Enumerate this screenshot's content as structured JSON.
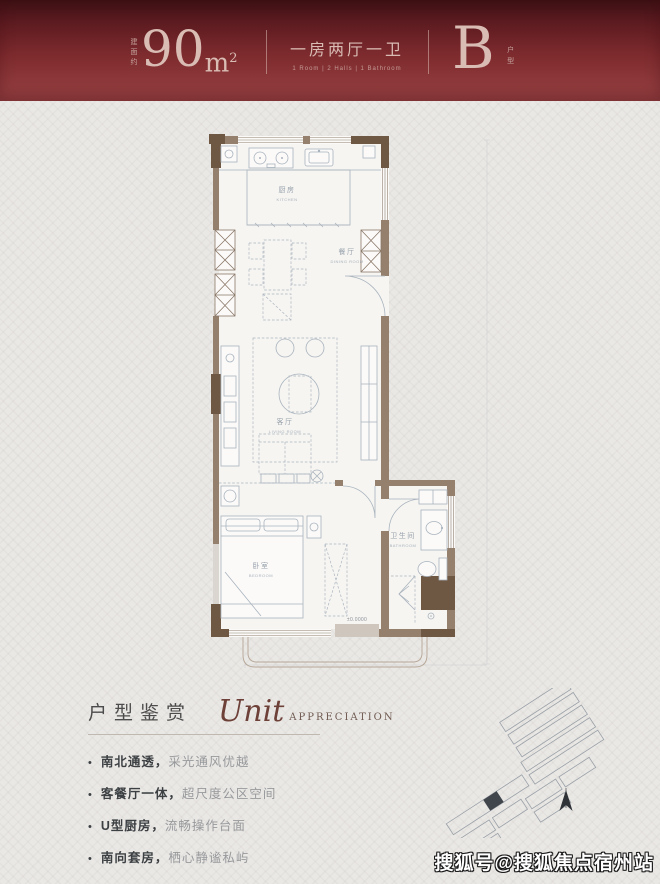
{
  "header": {
    "area_prefix": "建面约",
    "area_number": "90",
    "area_unit": "m",
    "area_sup": "2",
    "rooms_cn": "一房两厅一卫",
    "rooms_en": "1 Room | 2 Halls | 1 Bathroom",
    "unit_letter": "B",
    "unit_suffix": "户型"
  },
  "floorplan": {
    "labels": {
      "kitchen_cn": "厨房",
      "kitchen_en": "KITCHEN",
      "dining_cn": "餐厅",
      "dining_en": "DINING ROOM",
      "living_cn": "客厅",
      "living_en": "LIVING ROOM",
      "bedroom_cn": "卧室",
      "bedroom_en": "BEDROOM",
      "bath_cn": "卫生间",
      "bath_en": "BATHROOM",
      "level": "±0.0000"
    }
  },
  "appreciation": {
    "title_cn": "户型鉴赏",
    "title_script": "Unit",
    "title_en": "APPRECIATION",
    "bullets": [
      {
        "head": "南北通透，",
        "tail": "采光通风优越"
      },
      {
        "head": "客餐厅一体，",
        "tail": "超尺度公区空间"
      },
      {
        "head": "U型厨房，",
        "tail": "流畅操作台面"
      },
      {
        "head": "南向套房，",
        "tail": "栖心静谧私屿"
      }
    ]
  },
  "watermark": "搜狐号@搜狐焦点宿州站",
  "colors": {
    "header_red": "#7e2b2e",
    "header_text": "#d9bcb4",
    "wall_brown": "#94806c",
    "wall_dark": "#6e5743",
    "plan_line": "#a9b3bd",
    "script_accent": "#6d4038"
  }
}
